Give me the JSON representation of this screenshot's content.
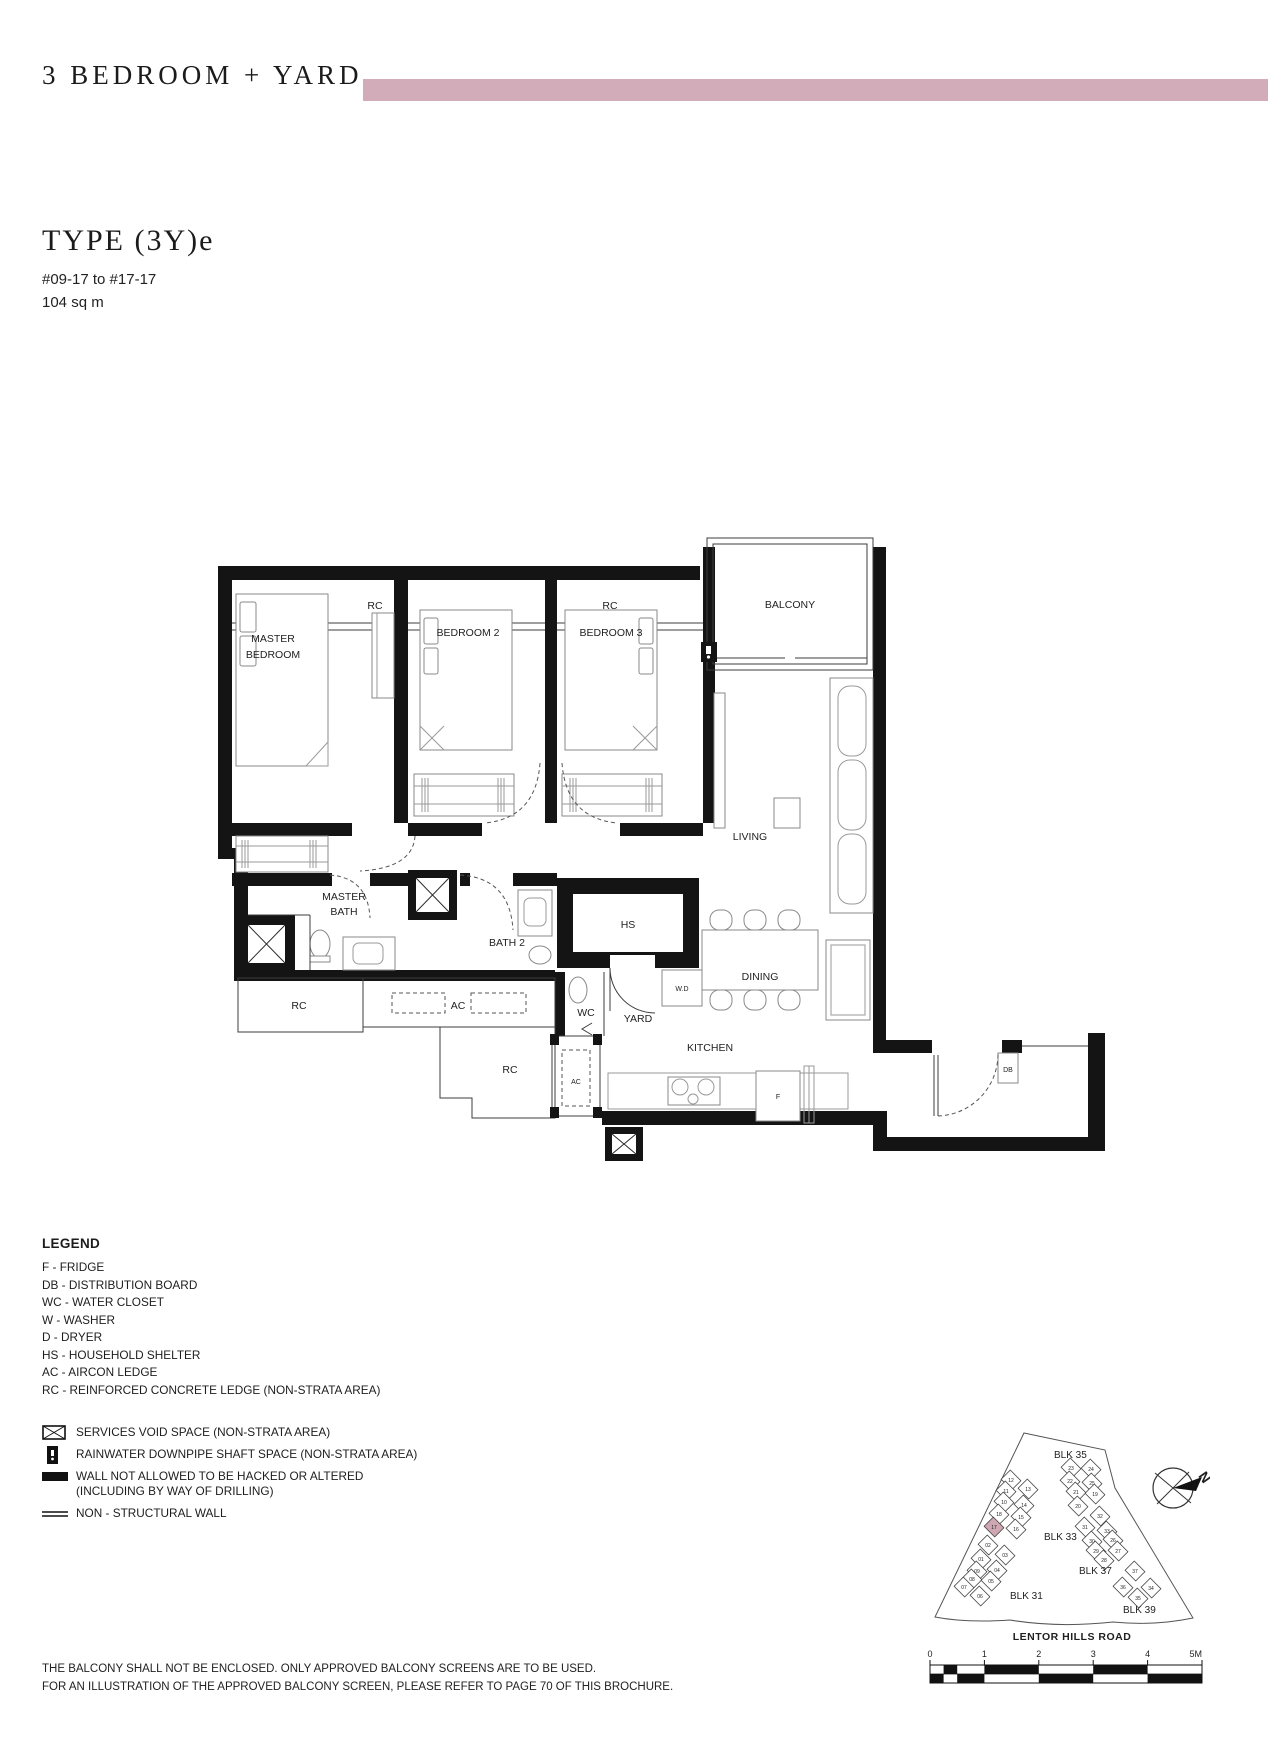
{
  "page": {
    "category_title": "3 BEDROOM + YARD",
    "accent_color": "#d2acb8",
    "type_title": "TYPE (3Y)e",
    "unit_range": "#09-17 to #17-17",
    "area": "104 sq m"
  },
  "plan": {
    "labels": {
      "rc": "RC",
      "ac": "AC",
      "balcony": "BALCONY",
      "master_l1": "MASTER",
      "master_l2": "BEDROOM",
      "bedroom2": "BEDROOM 2",
      "bedroom3": "BEDROOM 3",
      "living": "LIVING",
      "mbath_l1": "MASTER",
      "mbath_l2": "BATH",
      "bath2": "BATH 2",
      "hs": "HS",
      "dining": "DINING",
      "wc": "WC",
      "yard": "YARD",
      "wd": "W.D",
      "kitchen": "KITCHEN",
      "f": "F",
      "db": "DB"
    }
  },
  "legend": {
    "title": "LEGEND",
    "abbreviations": [
      "F - FRIDGE",
      "DB - DISTRIBUTION BOARD",
      "WC - WATER CLOSET",
      "W - WASHER",
      "D - DRYER",
      "HS - HOUSEHOLD SHELTER",
      "AC - AIRCON LEDGE",
      "RC - REINFORCED CONCRETE LEDGE (NON-STRATA AREA)"
    ],
    "symbols": [
      {
        "icon": "services-void-icon",
        "label": "SERVICES VOID SPACE (NON-STRATA AREA)"
      },
      {
        "icon": "rainwater-downpipe-icon",
        "label": "RAINWATER DOWNPIPE SHAFT SPACE (NON-STRATA AREA)"
      },
      {
        "icon": "hacking-wall-icon",
        "label": "WALL NOT ALLOWED TO BE HACKED OR ALTERED",
        "label2": "(INCLUDING BY WAY OF DRILLING)"
      },
      {
        "icon": "non-structural-wall-icon",
        "label": "NON - STRUCTURAL WALL"
      }
    ]
  },
  "site_plan": {
    "highlight_color": "#cfa7b3",
    "highlight_unit": "17",
    "road": "LENTOR HILLS ROAD",
    "north_label": "N",
    "blocks": [
      {
        "label": "BLK 35",
        "x": 224,
        "y": 178
      },
      {
        "label": "BLK 33",
        "x": 214,
        "y": 260
      },
      {
        "label": "BLK 37",
        "x": 249,
        "y": 294
      },
      {
        "label": "BLK 31",
        "x": 180,
        "y": 319
      },
      {
        "label": "BLK 39",
        "x": 293,
        "y": 333
      }
    ],
    "units": [
      {
        "n": "12",
        "x": 181,
        "y": 200
      },
      {
        "n": "11",
        "x": 176,
        "y": 211
      },
      {
        "n": "13",
        "x": 198,
        "y": 209
      },
      {
        "n": "10",
        "x": 174,
        "y": 222
      },
      {
        "n": "14",
        "x": 194,
        "y": 225
      },
      {
        "n": "18",
        "x": 169,
        "y": 234
      },
      {
        "n": "15",
        "x": 191,
        "y": 237
      },
      {
        "n": "17",
        "x": 164,
        "y": 247
      },
      {
        "n": "16",
        "x": 186,
        "y": 249
      },
      {
        "n": "02",
        "x": 158,
        "y": 265
      },
      {
        "n": "01",
        "x": 151,
        "y": 279
      },
      {
        "n": "03",
        "x": 175,
        "y": 275
      },
      {
        "n": "09",
        "x": 147,
        "y": 291
      },
      {
        "n": "04",
        "x": 167,
        "y": 290
      },
      {
        "n": "08",
        "x": 142,
        "y": 299
      },
      {
        "n": "05",
        "x": 161,
        "y": 301
      },
      {
        "n": "07",
        "x": 134,
        "y": 307
      },
      {
        "n": "06",
        "x": 150,
        "y": 316
      },
      {
        "n": "23",
        "x": 241,
        "y": 188
      },
      {
        "n": "24",
        "x": 261,
        "y": 189
      },
      {
        "n": "22",
        "x": 240,
        "y": 201
      },
      {
        "n": "25",
        "x": 262,
        "y": 203
      },
      {
        "n": "21",
        "x": 246,
        "y": 212
      },
      {
        "n": "19",
        "x": 265,
        "y": 214
      },
      {
        "n": "20",
        "x": 248,
        "y": 226
      },
      {
        "n": "32",
        "x": 270,
        "y": 236
      },
      {
        "n": "31",
        "x": 255,
        "y": 247
      },
      {
        "n": "33",
        "x": 277,
        "y": 251
      },
      {
        "n": "30",
        "x": 262,
        "y": 261
      },
      {
        "n": "26",
        "x": 283,
        "y": 260
      },
      {
        "n": "29",
        "x": 266,
        "y": 271
      },
      {
        "n": "27",
        "x": 288,
        "y": 271
      },
      {
        "n": "28",
        "x": 274,
        "y": 280
      },
      {
        "n": "37",
        "x": 305,
        "y": 291
      },
      {
        "n": "36",
        "x": 293,
        "y": 307
      },
      {
        "n": "34",
        "x": 321,
        "y": 308
      },
      {
        "n": "35",
        "x": 308,
        "y": 318
      }
    ],
    "scale_labels": [
      "0",
      "1",
      "2",
      "3",
      "4",
      "5M"
    ]
  },
  "footnotes": [
    "THE BALCONY SHALL NOT BE ENCLOSED. ONLY APPROVED BALCONY SCREENS ARE TO BE USED.",
    "FOR AN ILLUSTRATION OF THE APPROVED BALCONY SCREEN, PLEASE REFER TO PAGE 70 OF THIS BROCHURE."
  ]
}
